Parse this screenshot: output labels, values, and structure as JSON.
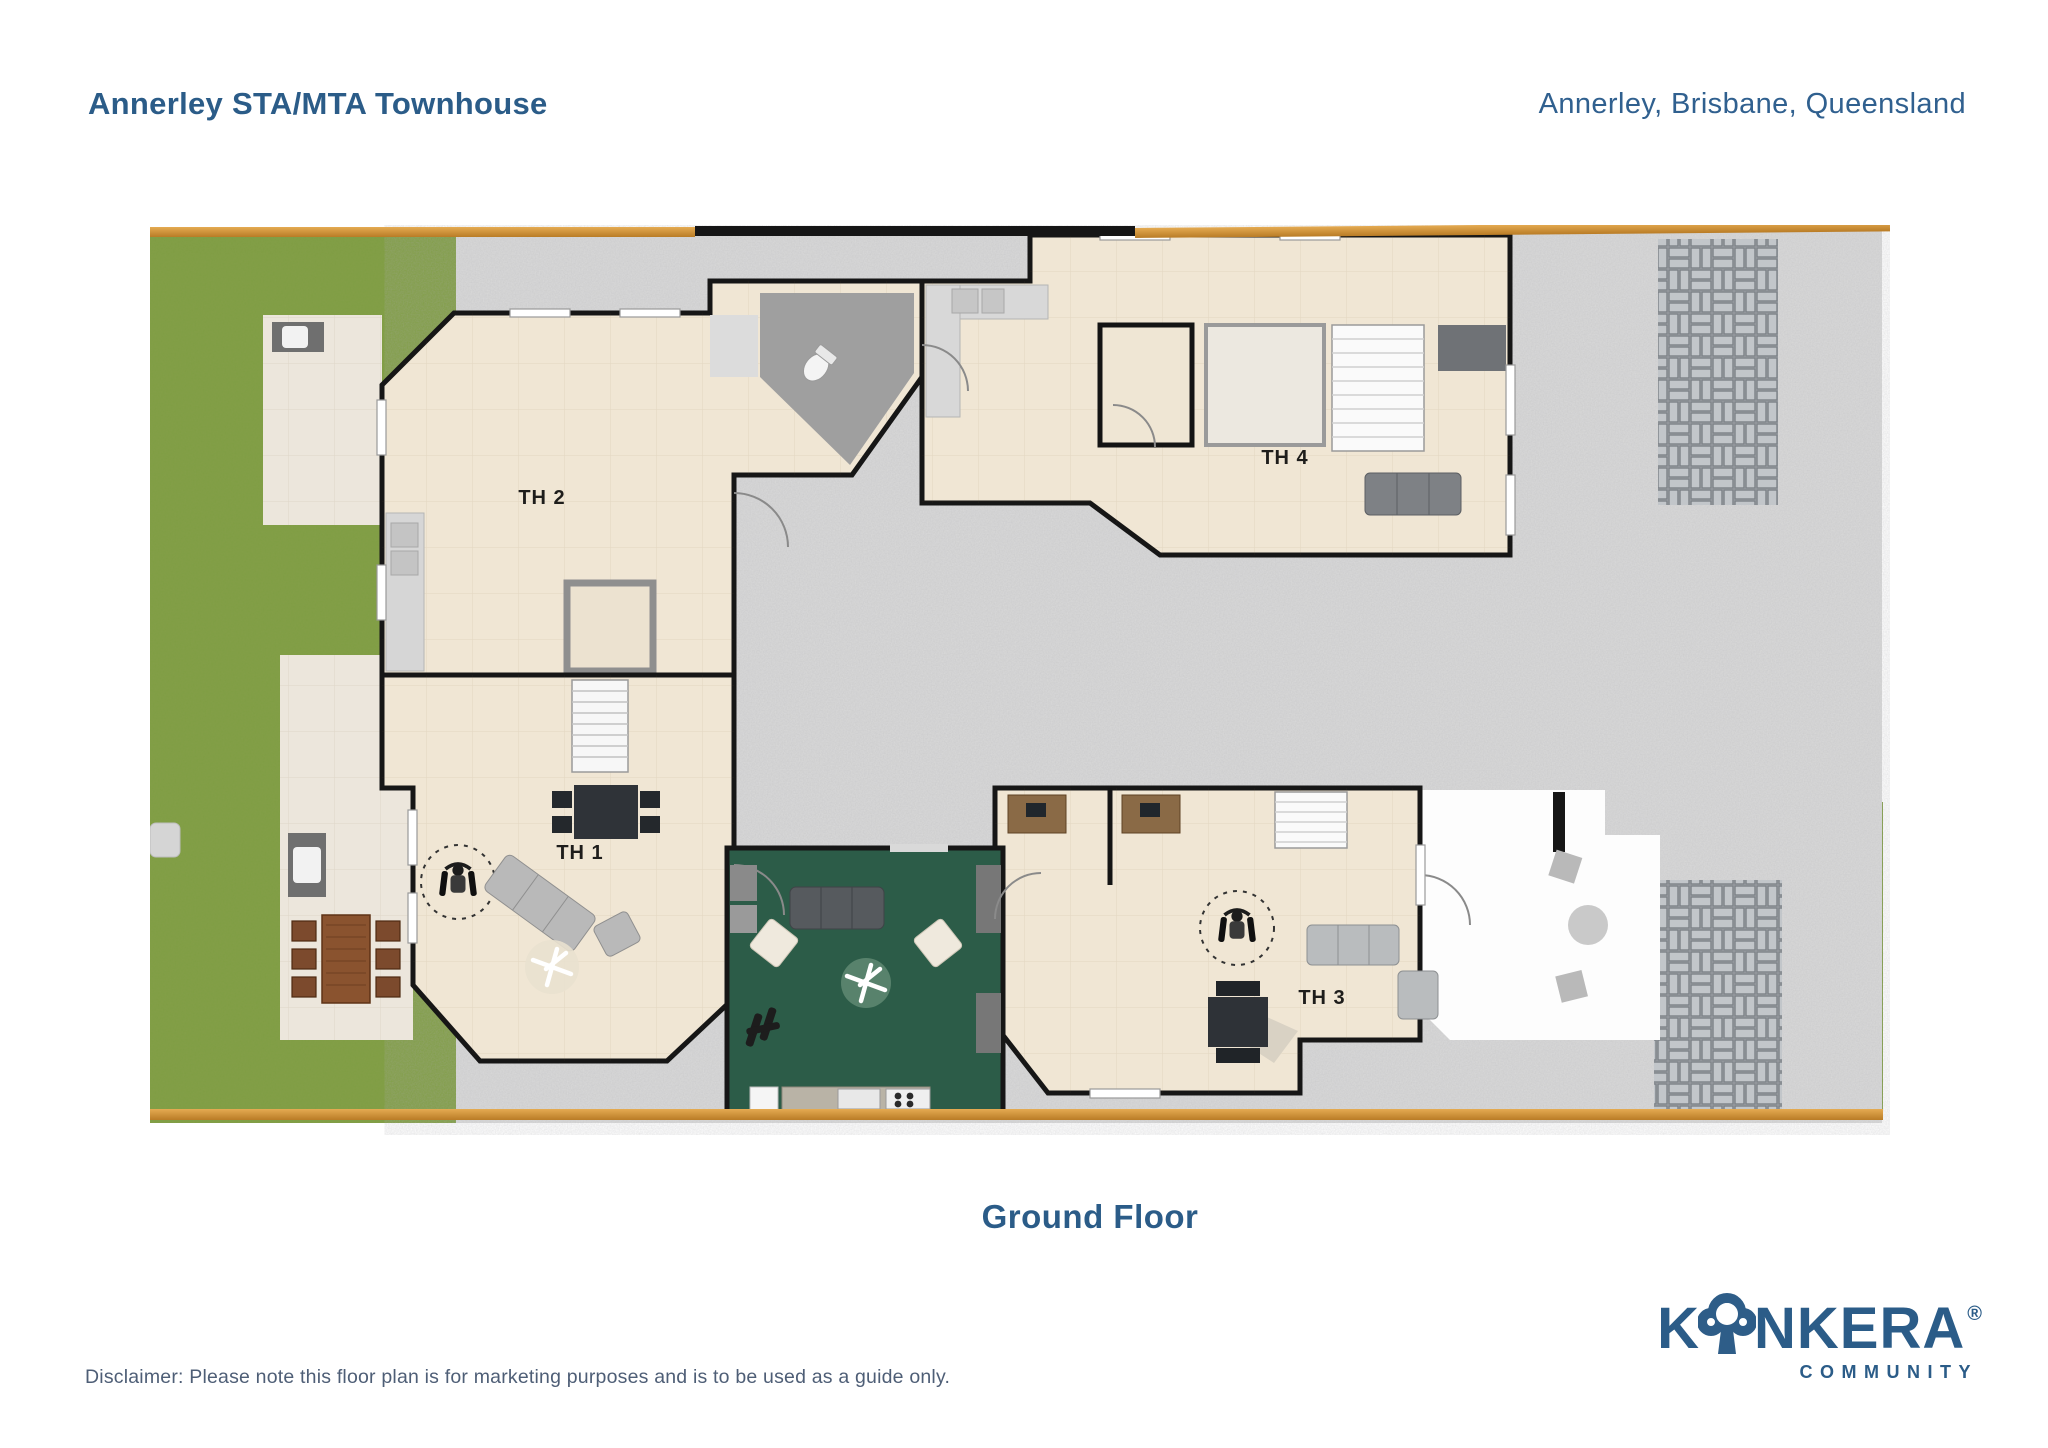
{
  "header": {
    "title": "Annerley STA/MTA Townhouse",
    "location": "Annerley, Brisbane, Queensland"
  },
  "plan": {
    "floor_label": "Ground Floor",
    "units": [
      {
        "id": "th1",
        "label": "TH 1"
      },
      {
        "id": "th2",
        "label": "TH 2"
      },
      {
        "id": "th3",
        "label": "TH 3"
      },
      {
        "id": "th4",
        "label": "TH 4"
      }
    ],
    "features": [
      "communal-lounge",
      "driveway",
      "lawn",
      "paved-courtyards",
      "outdoor-dining",
      "wheelchair-accessible-turning-circles",
      "stairs",
      "timber-fence"
    ]
  },
  "footer": {
    "disclaimer": "Disclaimer: Please note this floor plan is for marketing purposes and is to be used as a guide only.",
    "logo": {
      "brand_prefix": "K",
      "brand_suffix": "NKERA",
      "registered_mark": "®",
      "subtitle": "COMMUNITY"
    }
  },
  "colors": {
    "accent": "#2b5c88",
    "accent2": "#30608f",
    "muted": "#4e5e76",
    "grass": "#7f9d43",
    "drive": "#dadada",
    "floor": "#f0e6d4",
    "patio": "#ece6dc",
    "wall": "#161616",
    "greenroom": "#2c5c48",
    "fence": "#d99b3e",
    "fence2": "#b97c26",
    "paverbg": "#a7abb0",
    "paverbrick": "#c2c6ca",
    "whitepatio": "#fdfdfd"
  }
}
